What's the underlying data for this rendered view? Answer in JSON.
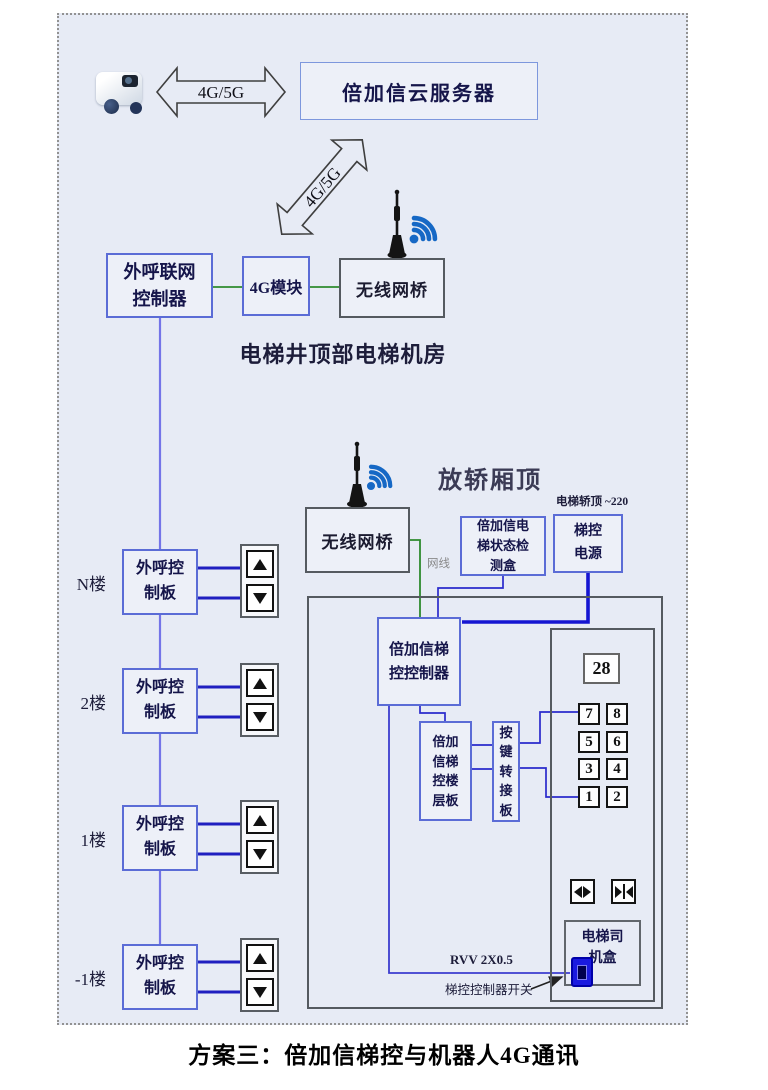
{
  "page": {
    "caption": "方案三：倍加信梯控与机器人4G通讯"
  },
  "cloud_server": {
    "label": "倍加信云服务器"
  },
  "links": {
    "robot_cloud_label": "4G/5G",
    "cloud_room_label": "4G/5G"
  },
  "machine_room": {
    "caption": "电梯井顶部电梯机房",
    "outcall_controller": "外呼联网\n控制器",
    "module_4g": "4G模块",
    "wireless_bridge": "无线网桥"
  },
  "car_top": {
    "caption": "放轿厢顶",
    "wireless_bridge": "无线网桥",
    "status_box": "倍加信电\n梯状态检\n测盒",
    "power_box": "梯控\n电源",
    "power_note": "电梯轿顶 ~220",
    "net_cable_label": "网线"
  },
  "car_panel": {
    "elevator_controller": "倍加信梯\n控控制器",
    "floor_board": "倍加\n信梯\n控楼\n层板",
    "key_adapter": "按\n键\n转\n接\n板",
    "floor_display": "28",
    "buttons": [
      "7",
      "8",
      "5",
      "6",
      "3",
      "4",
      "1",
      "2"
    ],
    "driver_box": "电梯司\n机盒",
    "wire_label": "RVV 2X0.5",
    "switch_label": "梯控控制器开关"
  },
  "floors": [
    {
      "label": "N楼",
      "board": "外呼控\n制板"
    },
    {
      "label": "2楼",
      "board": "外呼控\n制板"
    },
    {
      "label": "1楼",
      "board": "外呼控\n制板"
    },
    {
      "label": "-1楼",
      "board": "外呼控\n制板"
    }
  ],
  "icons": {
    "robot": "robot-icon",
    "antenna": "antenna-icon",
    "wifi": "wifi-icon",
    "up": "up-arrow-icon",
    "down": "down-arrow-icon",
    "door_open": "door-open-icon",
    "door_close": "door-close-icon",
    "switch": "switch-icon"
  },
  "colors": {
    "box_border_blue": "#5b6cd6",
    "wire_blue": "#2a2acc",
    "wire_green": "#2e8b2e",
    "power_wire_blue": "#1515d2",
    "wifi_blue": "#1668c5",
    "background": "#e7ebf5"
  }
}
